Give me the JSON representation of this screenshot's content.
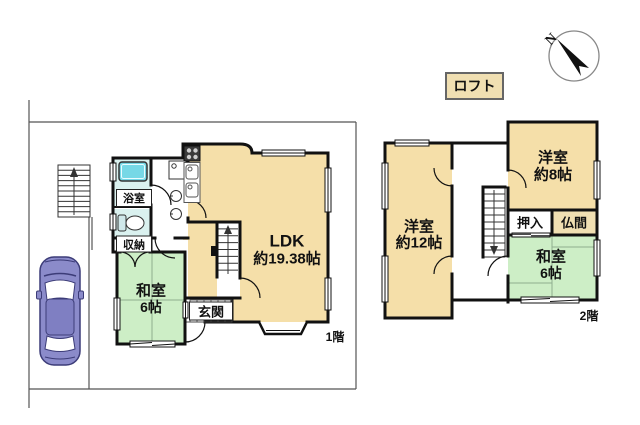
{
  "badges": {
    "loft": "ロフト",
    "floor1": "1階",
    "floor2": "2階"
  },
  "compass": {
    "north": "N"
  },
  "floor1": {
    "ldk_name": "LDK",
    "ldk_size": "約19.38帖",
    "washitsu_name": "和室",
    "washitsu_size": "6帖",
    "genkan": "玄関",
    "bathroom": "浴室",
    "storage": "収納"
  },
  "floor2": {
    "west_room_name": "洋室",
    "west_room_size": "約12帖",
    "east_room_name": "洋室",
    "east_room_size": "約8帖",
    "washitsu_name": "和室",
    "washitsu_size": "6帖",
    "oshiire": "押入",
    "butsuma": "仏間"
  },
  "colors": {
    "room_cream": "#f5dfa9",
    "room_green": "#cdeec6",
    "room_cyan": "#daf1ef",
    "bathtub_cyan": "#76d8e6",
    "badge_tan": "#f0dfb2",
    "wall_black": "#111111",
    "car_body": "#8b8bca",
    "car_roof": "#7f7fc2"
  }
}
